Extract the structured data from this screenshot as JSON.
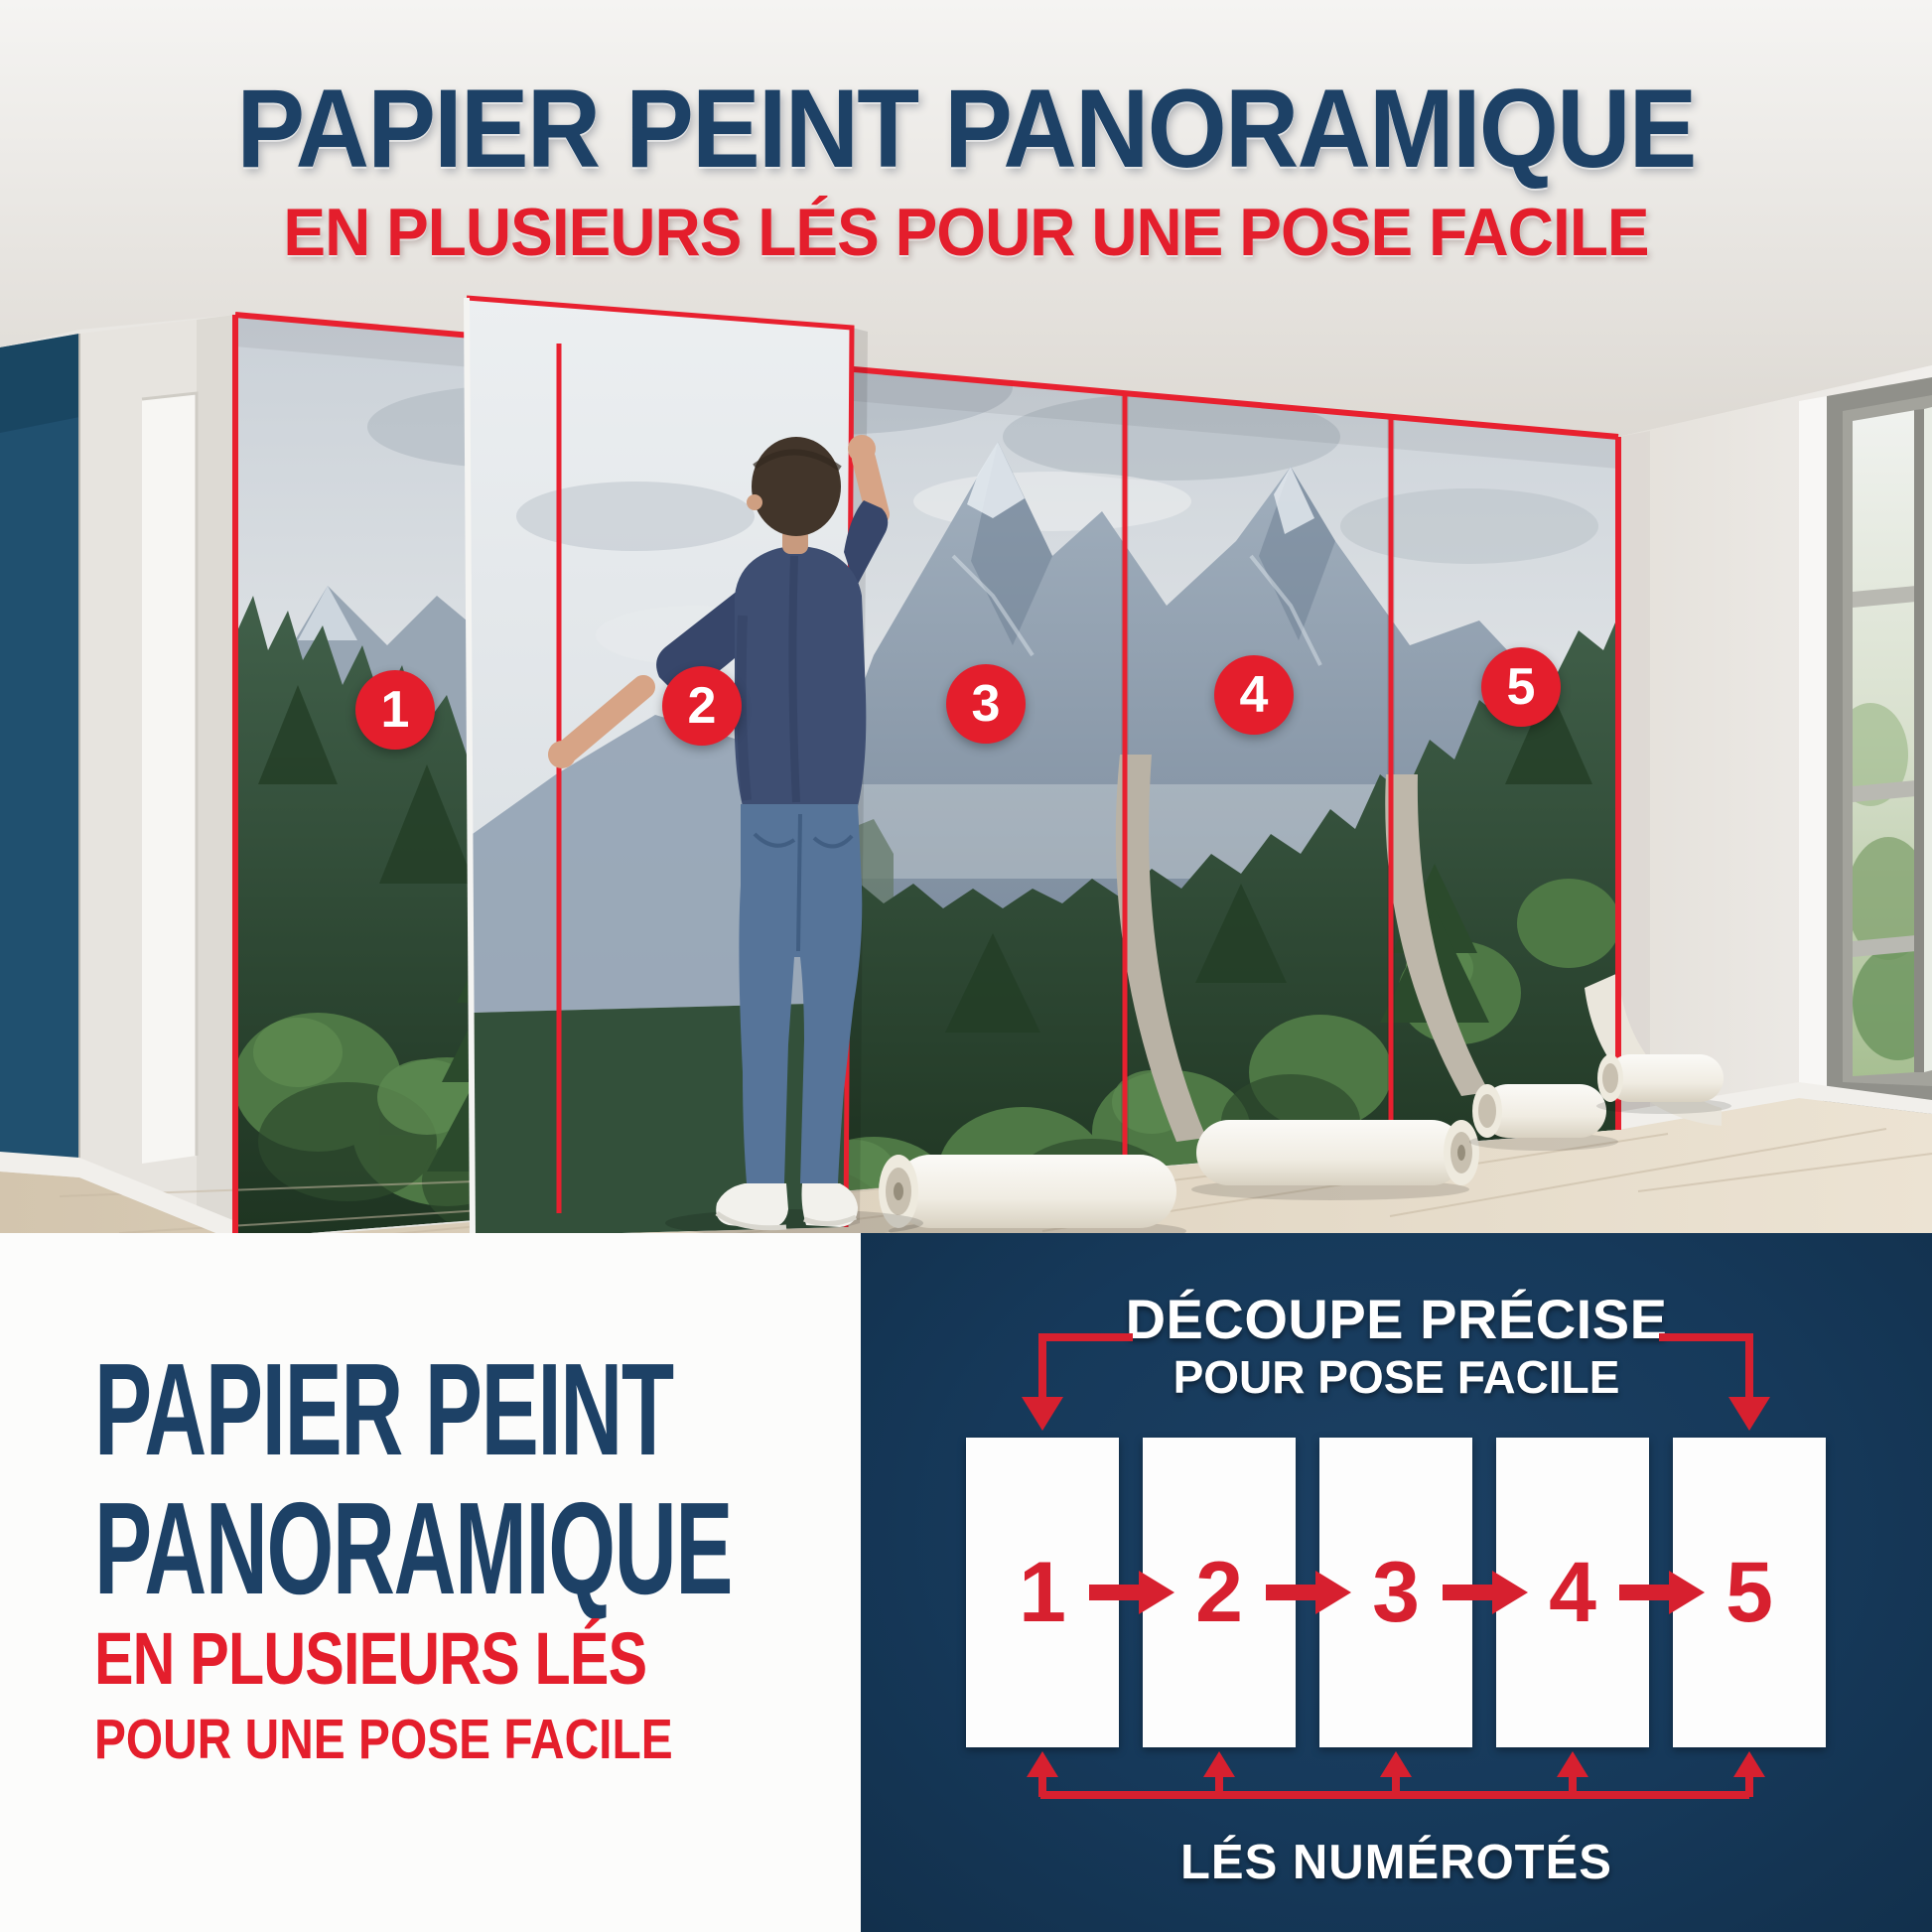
{
  "header": {
    "title": "PAPIER PEINT PANORAMIQUE",
    "subtitle": "EN PLUSIEURS LÉS POUR UNE POSE FACILE"
  },
  "photo": {
    "strip_numbers": [
      "1",
      "2",
      "3",
      "4",
      "5"
    ]
  },
  "bottom_left": {
    "title_line1": "PAPIER PEINT",
    "title_line2": "PANORAMIQUE",
    "subtitle_line1": "EN PLUSIEURS LÉS",
    "subtitle_line2": "POUR UNE POSE FACILE"
  },
  "diagram": {
    "title": "DÉCOUPE PRÉCISE",
    "subtitle": "POUR POSE FACILE",
    "strip_numbers": [
      "1",
      "2",
      "3",
      "4",
      "5"
    ],
    "caption": "LÉS NUMÉROTÉS"
  },
  "colors": {
    "navy_title": "#1d4166",
    "red": "#e41e2c",
    "panel_navy": "#16395a",
    "diagram_red": "#d7202f",
    "accent_wall": "#20506f"
  }
}
